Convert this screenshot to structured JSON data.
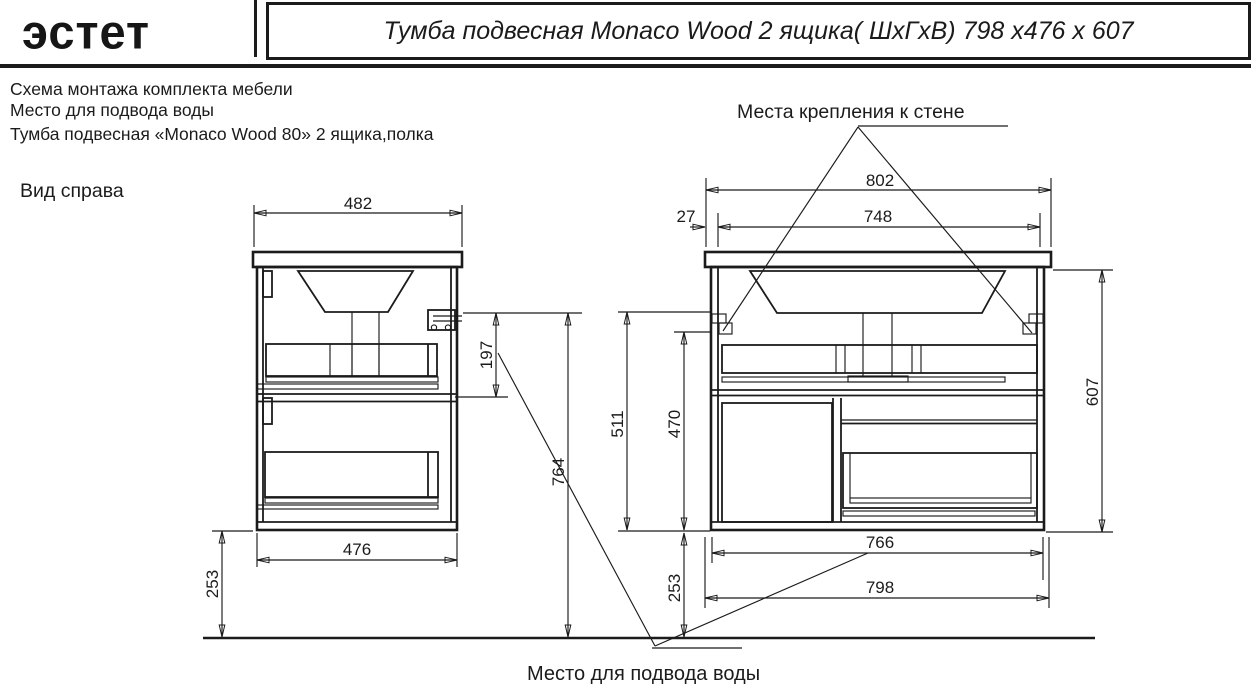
{
  "colors": {
    "line": "#1b1b1b",
    "background": "#ffffff"
  },
  "header": {
    "logo_text": "эстет",
    "title": "Тумба подвесная Monaco Wood 2 ящика( ШхГхВ) 798 х476 х 607"
  },
  "notes": {
    "line1": "Схема монтажа комплекта мебели",
    "line2": "Место для подвода воды",
    "line3": "Тумба подвесная «Monaco Wood 80» 2 ящика,полка"
  },
  "side_view": {
    "caption": "Вид справа",
    "dim_top_width": "482",
    "dim_bracket_drop": "197",
    "dim_mount_height": "764",
    "dim_bottom_width": "476",
    "dim_floor_clearance": "253"
  },
  "front_view": {
    "caption_wall_mount": "Места крепления к стене",
    "dim_bracket_span": "802",
    "dim_edge_offset": "27",
    "dim_mount_spacing": "748",
    "dim_bottom_to_top_mount": "511",
    "dim_bottom_to_bracket": "470",
    "dim_overall_height": "607",
    "dim_body_width": "766",
    "dim_overall_width": "798",
    "dim_floor_clearance": "253"
  },
  "footer": {
    "caption_water_supply": "Место для подвода воды"
  }
}
